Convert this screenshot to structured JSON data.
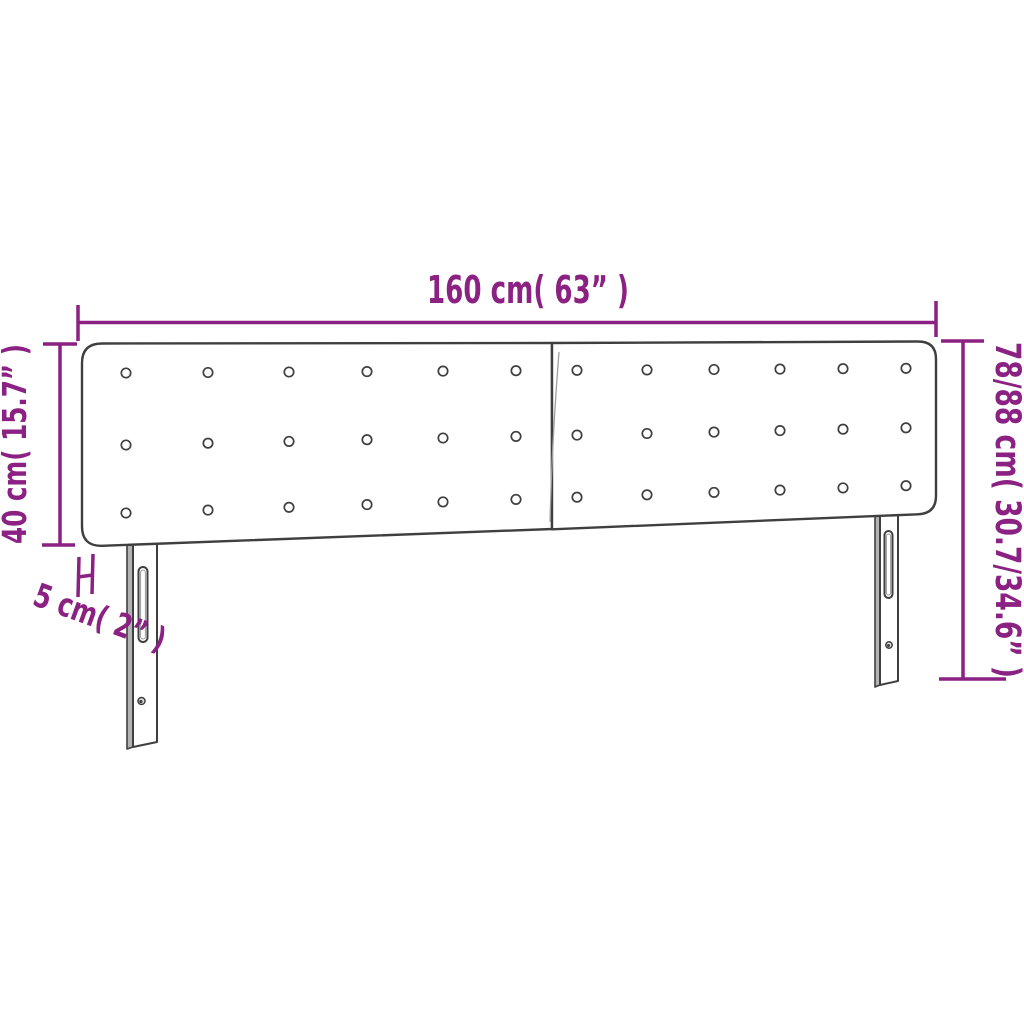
{
  "diagram": {
    "type": "product-dimension-diagram",
    "subject": "two-panel button-tufted headboard with two slotted legs",
    "dimension_labels": {
      "width": "160 cm( 63” )",
      "total_height": "78/88 cm( 30.7/34.6” )",
      "panel_height": "40 cm( 15.7” )",
      "thickness": "5 cm( 2” )"
    },
    "colors": {
      "dimension_accent": "#8B2182",
      "line_art": "#3F3F3F",
      "background": "#FFFFFF"
    }
  }
}
